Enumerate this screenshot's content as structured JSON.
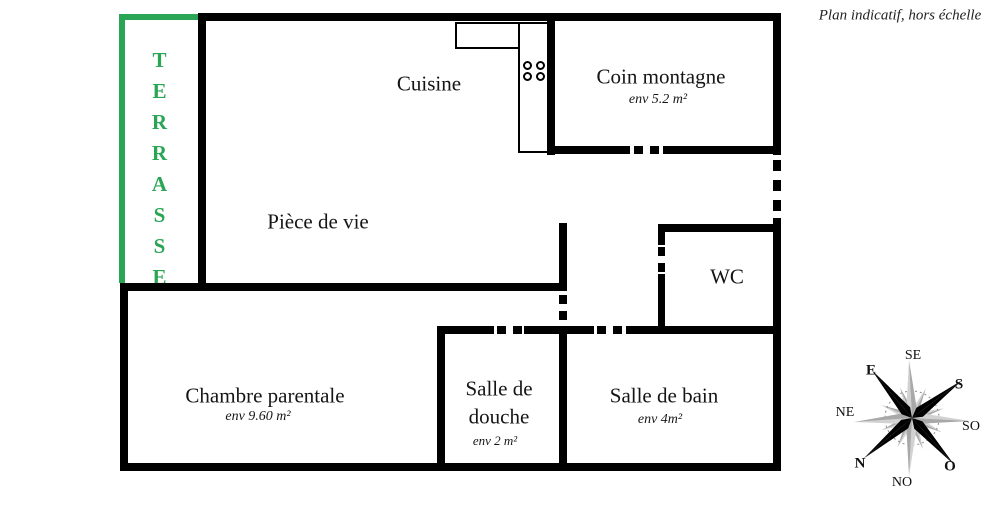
{
  "annotation": "Plan indicatif, hors échelle",
  "terrace": {
    "label": "TERRASSE",
    "color": "#2aa455"
  },
  "rooms": {
    "cuisine": {
      "name": "Cuisine"
    },
    "coin_montagne": {
      "name": "Coin montagne",
      "area": "env 5.2 m²"
    },
    "piece_de_vie": {
      "name": "Pièce de vie"
    },
    "wc": {
      "name": "WC"
    },
    "chambre_parentale": {
      "name": "Chambre parentale",
      "area": "env 9.60 m²"
    },
    "salle_de_douche": {
      "name": "Salle de douche",
      "area": "env 2 m²"
    },
    "salle_de_bain": {
      "name": "Salle de bain",
      "area": "env 4m²"
    }
  },
  "compass": {
    "directions": {
      "se": "SE",
      "e": "E",
      "s": "S",
      "ne": "NE",
      "so": "SO",
      "n": "N",
      "o": "O",
      "no": "NO"
    }
  },
  "colors": {
    "wall": "#000000",
    "terrace_green": "#2aa455",
    "compass_gray_light": "#d2d2d2",
    "compass_gray_dark": "#a8a8a8",
    "compass_black": "#000000"
  }
}
